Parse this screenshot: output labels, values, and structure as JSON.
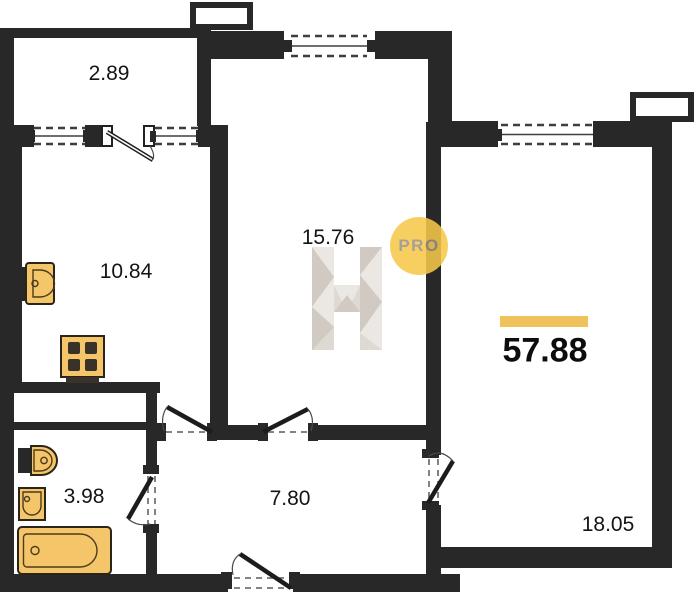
{
  "plan": {
    "total_area": "57.88",
    "rooms": {
      "balcony": {
        "area": "2.89"
      },
      "kitchen": {
        "area": "10.84"
      },
      "living": {
        "area": "15.76"
      },
      "bathroom": {
        "area": "3.98"
      },
      "hallway": {
        "area": "7.80"
      },
      "bedroom": {
        "area": "18.05"
      }
    },
    "watermark": {
      "logo_letter": "H",
      "badge": "PRO"
    },
    "fixtures": [
      "kitchen-sink-icon",
      "stove-icon",
      "toilet-icon",
      "washbasin-icon",
      "bathtub-icon"
    ],
    "colors": {
      "wall": "#282828",
      "line": "#3f3f3f",
      "fixture_fill": "#f5c569",
      "fixture_stroke": "#2b2418",
      "accent_bar": "#f0c25c",
      "badge_fill": "#f6c94a",
      "badge_text": "#99908a",
      "label": "#141414",
      "watermark_light": "#eae7e2",
      "watermark_mid": "#ddd8d1",
      "watermark_dark": "#cfc8bf"
    }
  }
}
